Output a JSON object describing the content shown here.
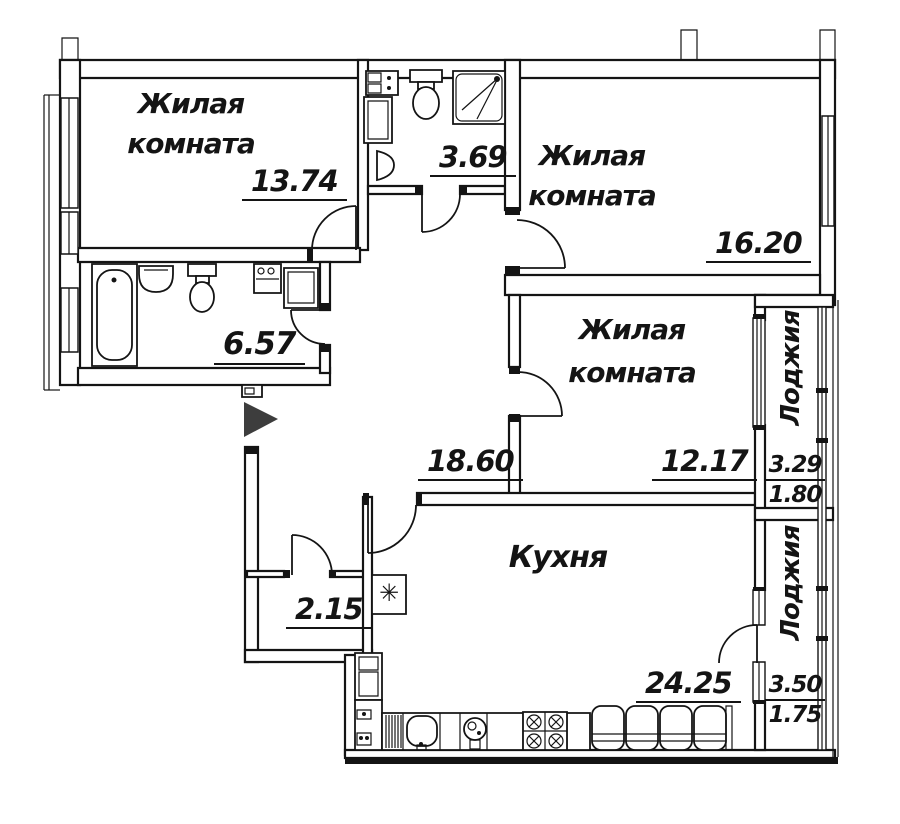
{
  "plan": {
    "type": "apartment-floor-plan",
    "language": "ru"
  },
  "colors": {
    "line": "#141414",
    "background": "#ffffff",
    "entrance_arrow": "#3d3d3d"
  },
  "rooms": {
    "living1": {
      "name_lines": [
        "Жилая",
        "комната"
      ],
      "area": "13.74"
    },
    "bath_small": {
      "area": "3.69"
    },
    "living2": {
      "name_lines": [
        "Жилая",
        "комната"
      ],
      "area": "16.20"
    },
    "living3": {
      "name_lines": [
        "Жилая",
        "комната"
      ],
      "area": "12.17"
    },
    "bathroom": {
      "area": "6.57"
    },
    "hallway": {
      "area": "18.60"
    },
    "storage": {
      "area": "2.15"
    },
    "kitchen": {
      "name": "Кухня",
      "area": "24.25"
    },
    "loggia1": {
      "name": "Лоджия",
      "area_full": "3.29",
      "area_reduced": "1.80"
    },
    "loggia2": {
      "name": "Лоджия",
      "area_full": "3.50",
      "area_reduced": "1.75"
    }
  },
  "symbols": {
    "vent": "✳"
  }
}
